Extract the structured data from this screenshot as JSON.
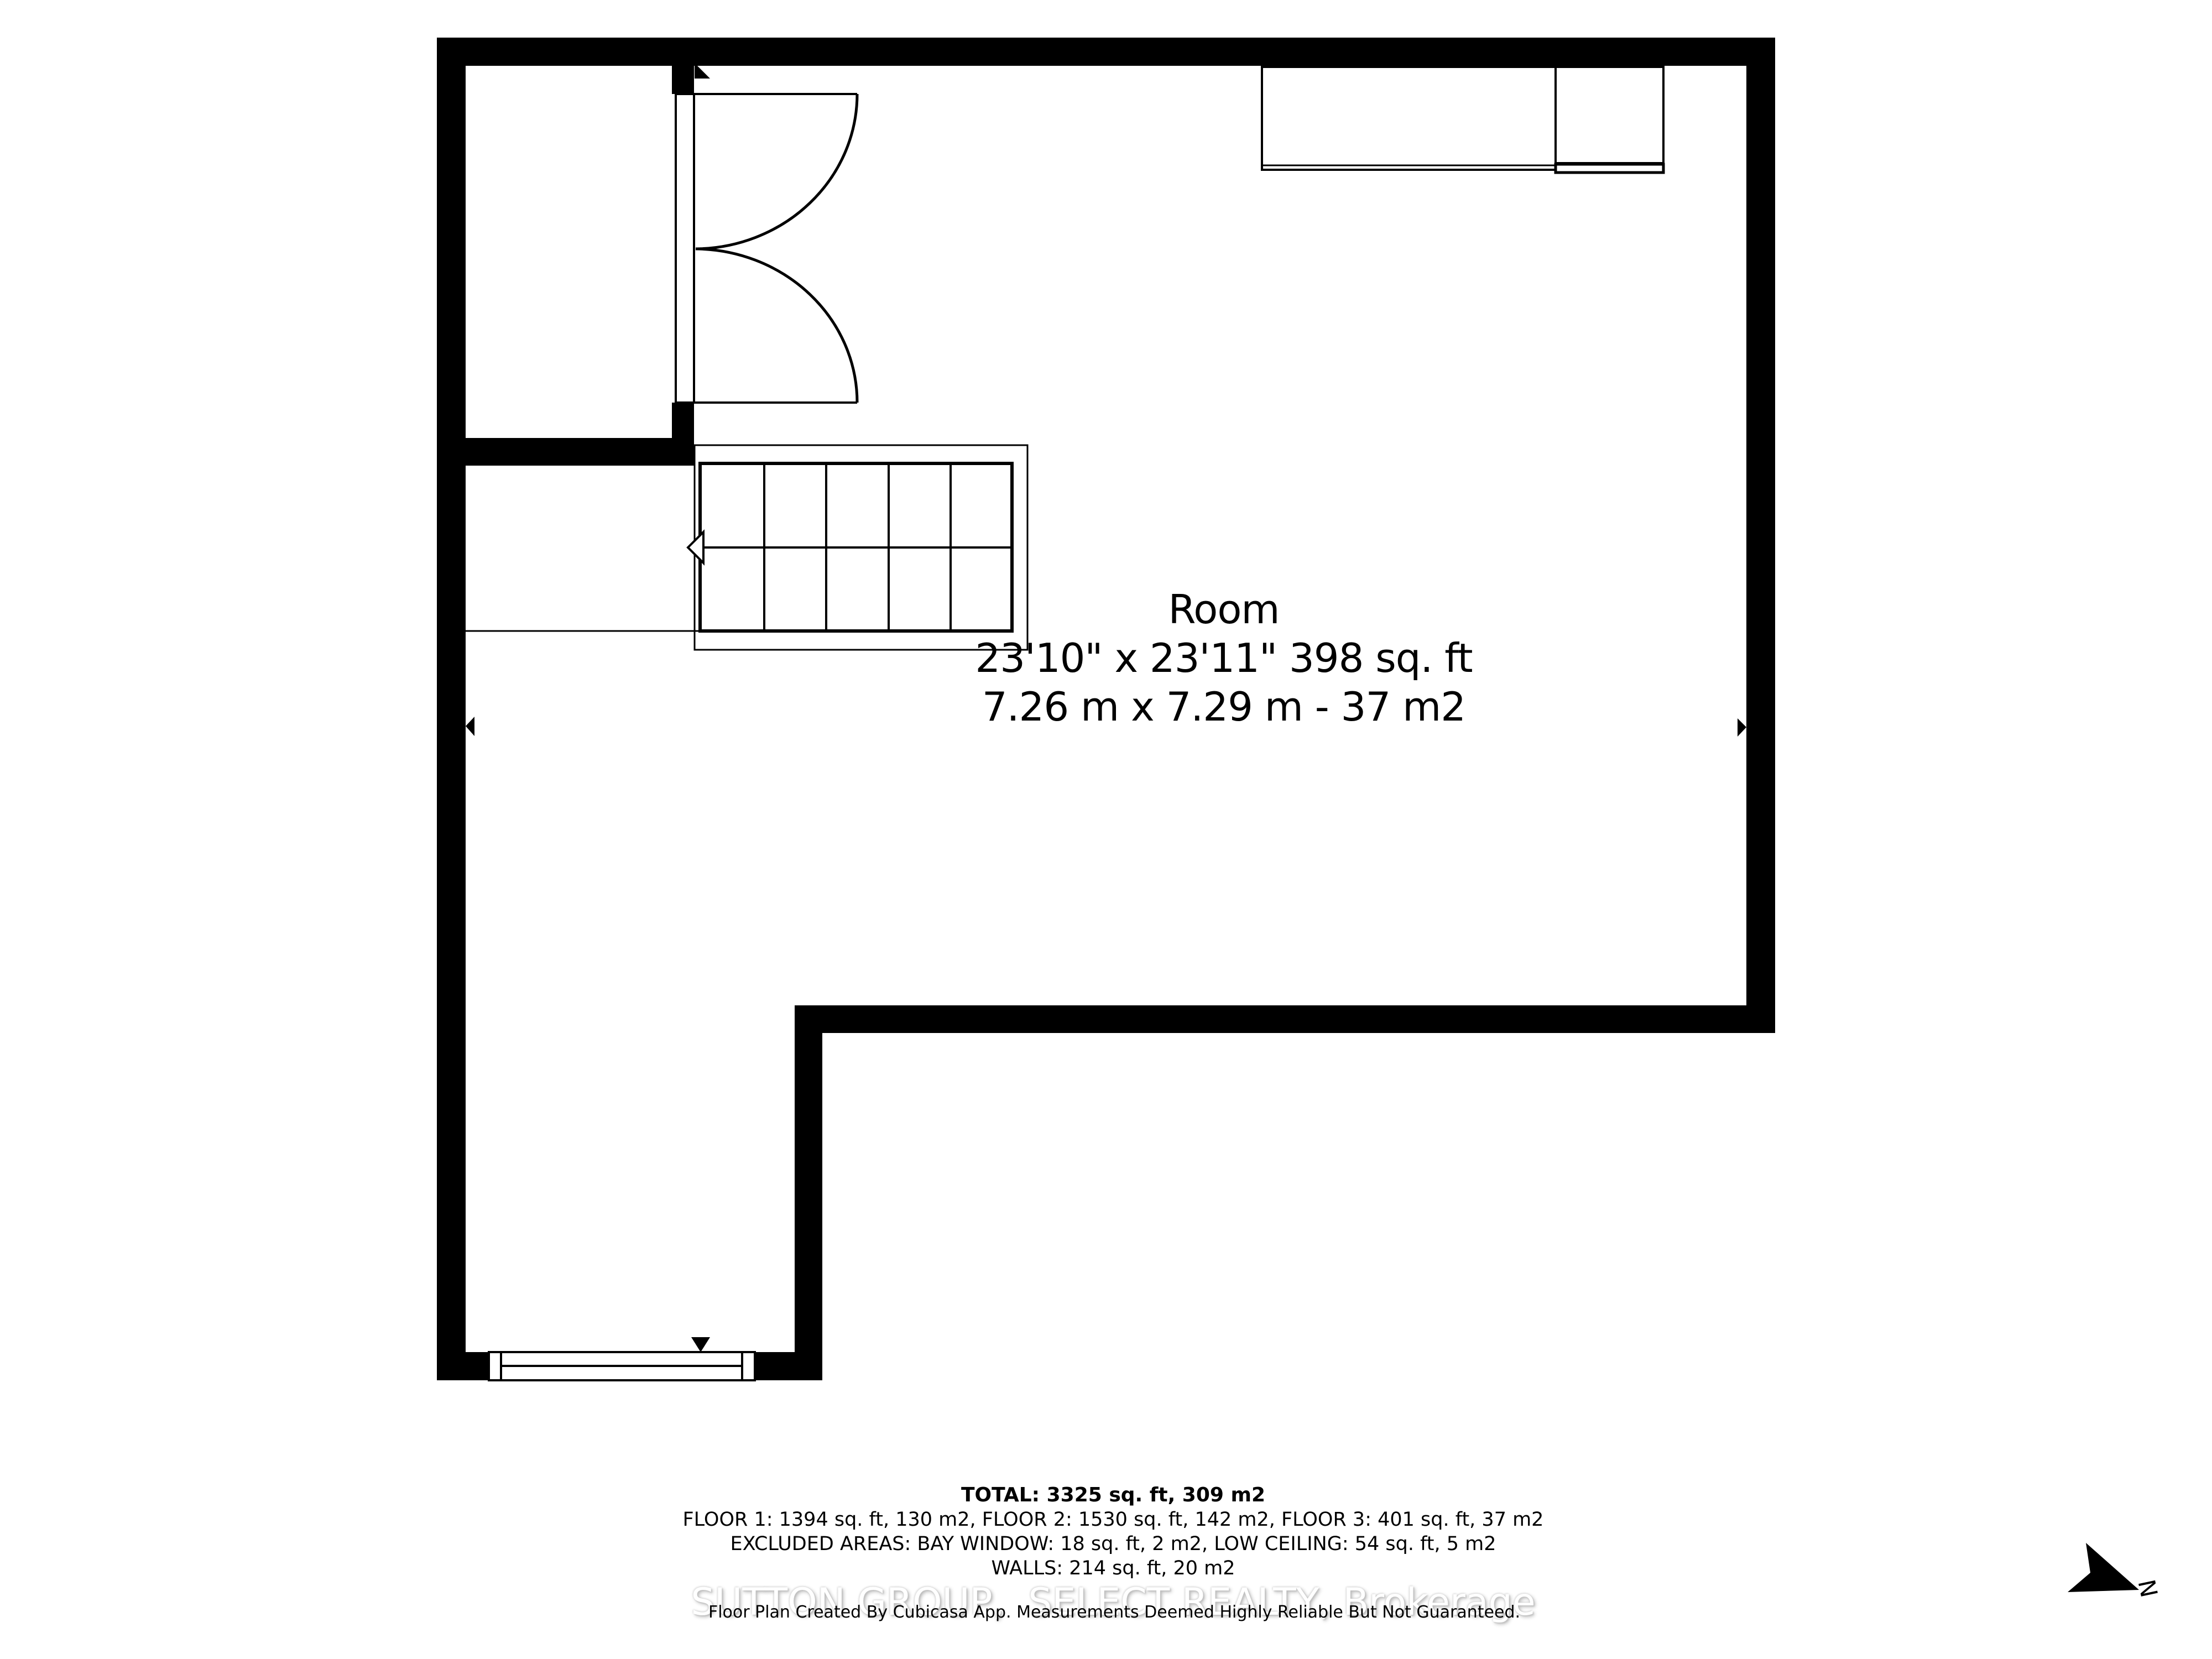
{
  "plan": {
    "room_label": {
      "name": "Room",
      "imperial": "23'10\" x 23'11\" 398 sq. ft",
      "metric": "7.26 m x 7.29 m - 37 m2"
    },
    "summary": {
      "total": "TOTAL: 3325 sq. ft, 309 m2",
      "floors": "FLOOR 1: 1394 sq. ft, 130 m2, FLOOR 2: 1530 sq. ft, 142 m2, FLOOR 3: 401 sq. ft, 37 m2",
      "excluded": "EXCLUDED AREAS: BAY WINDOW: 18 sq. ft, 2 m2, LOW CEILING: 54 sq. ft, 5 m2",
      "walls": "WALLS: 214 sq. ft, 20 m2"
    },
    "watermark": "SUTTON GROUP,  SELECT REALTY, Brokerage",
    "disclaimer": "Floor Plan Created By Cubicasa App. Measurements Deemed Highly Reliable But Not Guaranteed.",
    "compass": {
      "label": "N"
    }
  },
  "icons": {
    "north_arrow": "north-arrow-icon",
    "stairs_direction_arrow": "stairs-direction-arrow-icon",
    "door_swing_marker": "door-swing-marker-icon",
    "window_marker": "window-marker-icon",
    "dimension_arrow_left": "dimension-arrow-left-icon",
    "dimension_arrow_right": "dimension-arrow-right-icon"
  },
  "colors": {
    "line": "#000000",
    "background": "#ffffff",
    "watermark_fill": "#ffffff",
    "watermark_shadow": "#bdbdbd"
  }
}
